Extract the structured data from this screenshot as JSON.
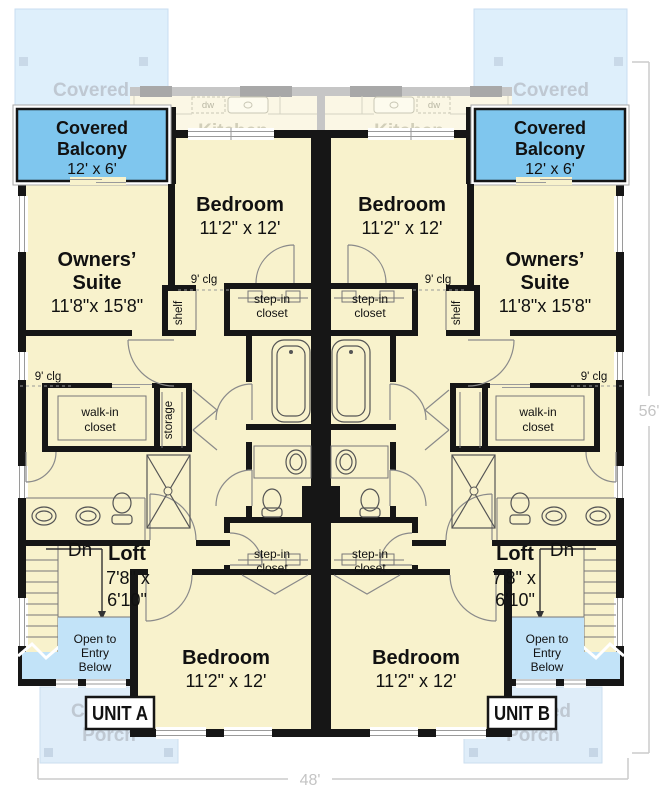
{
  "floor_plan": {
    "units": {
      "a": "UNIT A",
      "b": "UNIT B"
    },
    "overall_dims": {
      "width": "48'",
      "depth": "56'"
    },
    "rooms": {
      "covered_balcony": {
        "name1": "Covered",
        "name2": "Balcony",
        "dims": "12' x 6'"
      },
      "bedroom": {
        "name": "Bedroom",
        "dims": "11'2\" x 12'"
      },
      "owners_suite": {
        "name1": "Owners’",
        "name2": "Suite",
        "dims": "11'8\"x 15'8\""
      },
      "loft": {
        "name": "Loft",
        "dims1": "7'8\" x",
        "dims2": "6'10\""
      },
      "step_in_closet": {
        "line1": "step-in",
        "line2": "closet"
      },
      "walk_in_closet": {
        "line1": "walk-in",
        "line2": "closet"
      },
      "storage": "storage",
      "shelf": "shelf",
      "open_to_entry": {
        "line1": "Open to",
        "line2": "Entry",
        "line3": "Below"
      },
      "ceiling_height": "9' clg",
      "down": "Dn"
    },
    "ghost_floor_below": {
      "patio1": "Covered",
      "patio2": "Patio",
      "porch1": "Covered",
      "porch2": "Porch",
      "kitchen": "Kitchen",
      "dishwasher": "dw"
    },
    "colors": {
      "floor": "#F8F2CC",
      "balcony_blue": "#7FC6EE",
      "open_below_blue": "#C2E3F8",
      "ghost_blue": "#DEEFFB",
      "wall": "#161616",
      "dimension_gray": "#C4C4C4"
    }
  }
}
